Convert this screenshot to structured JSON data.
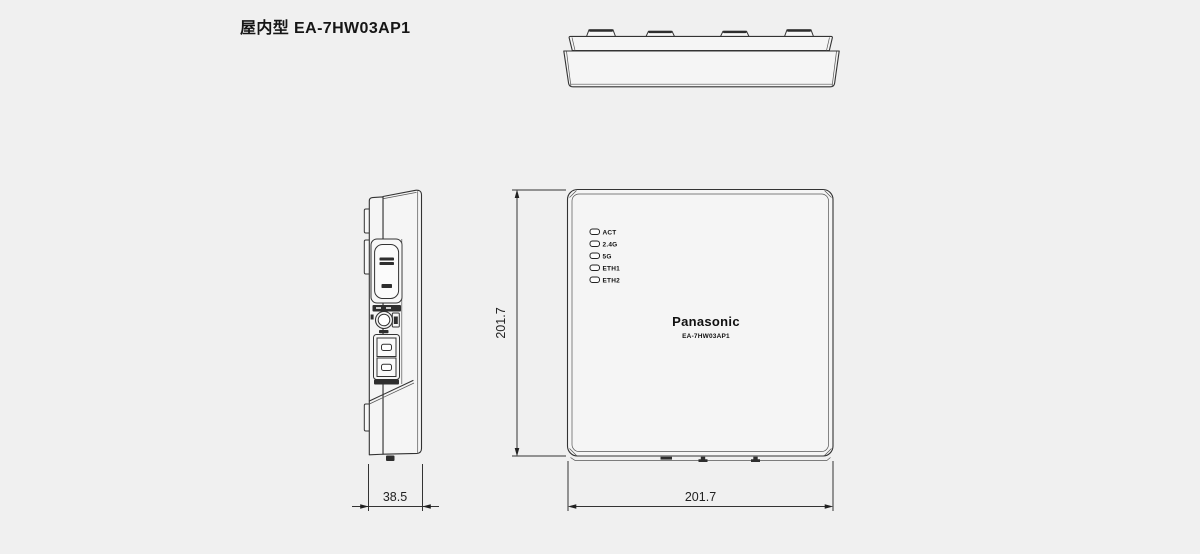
{
  "title": "屋内型 EA-7HW03AP1",
  "front_view": {
    "brand": "Panasonic",
    "model": "EA-7HW03AP1",
    "leds": [
      {
        "label": "ACT"
      },
      {
        "label": "2.4G"
      },
      {
        "label": "5G"
      },
      {
        "label": "ETH1"
      },
      {
        "label": "ETH2"
      }
    ]
  },
  "dimensions": {
    "height_mm": "201.7",
    "width_mm": "201.7",
    "depth_mm": "38.5"
  },
  "colors": {
    "background": "#f0f0f0",
    "line": "#333333",
    "dark_fill": "#2e2e2e",
    "device_face": "#f5f5f5"
  }
}
